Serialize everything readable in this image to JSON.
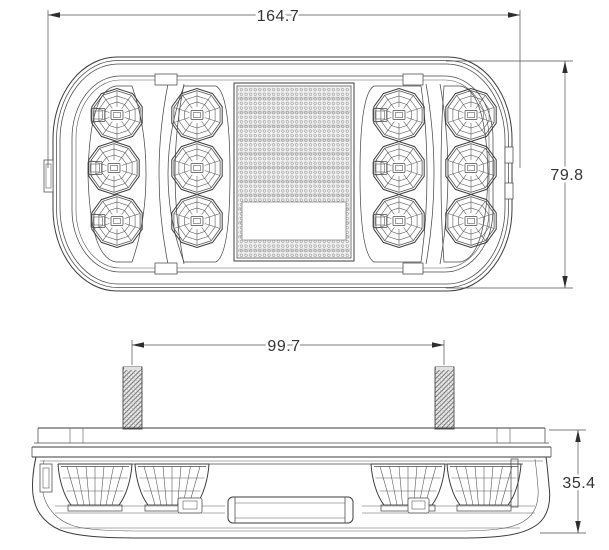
{
  "drawing": {
    "type": "technical-dimension-drawing",
    "subject": "led-rear-lamp",
    "dimensions": {
      "overall_width": "164.7",
      "overall_height": "79.8",
      "stud_spacing": "99.7",
      "overall_depth": "35.4"
    },
    "colors": {
      "background": "#ffffff",
      "object_line": "#3d3d3d",
      "dimension_line": "#4f4f4f",
      "hatch": "#8f8f8f"
    }
  }
}
